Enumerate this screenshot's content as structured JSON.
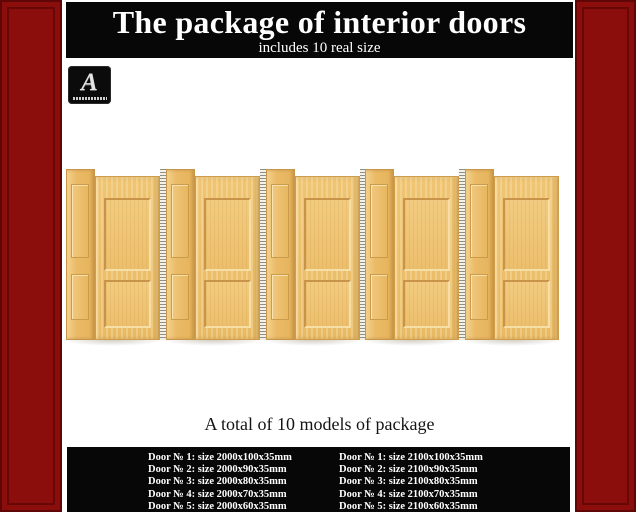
{
  "header": {
    "title": "The package of interior doors",
    "subtitle": "includes 10 real size"
  },
  "logo": {
    "letter": "A"
  },
  "summary": {
    "text": "A total of 10 models of package"
  },
  "specs": {
    "left_column": [
      "Door № 1: size 2000x100x35mm",
      "Door № 2: size 2000x90x35mm",
      "Door № 3: size 2000x80x35mm",
      "Door № 4: size 2000x70x35mm",
      "Door № 5: size 2000x60x35mm"
    ],
    "right_column": [
      "Door № 1: size 2100x100x35mm",
      "Door № 2: size 2100x90x35mm",
      "Door № 3: size 2100x80x35mm",
      "Door № 4: size 2100x70x35mm",
      "Door № 5: size 2100x60x35mm"
    ]
  },
  "doors": {
    "total_doors": 10,
    "door_groups": 5
  },
  "colors": {
    "frame_red": "#8C0E0C",
    "banner_black": "#070707",
    "wood_base": "#ECBE6E",
    "wood_panel": "#F0C97E",
    "text_white": "#FFFFFF"
  }
}
